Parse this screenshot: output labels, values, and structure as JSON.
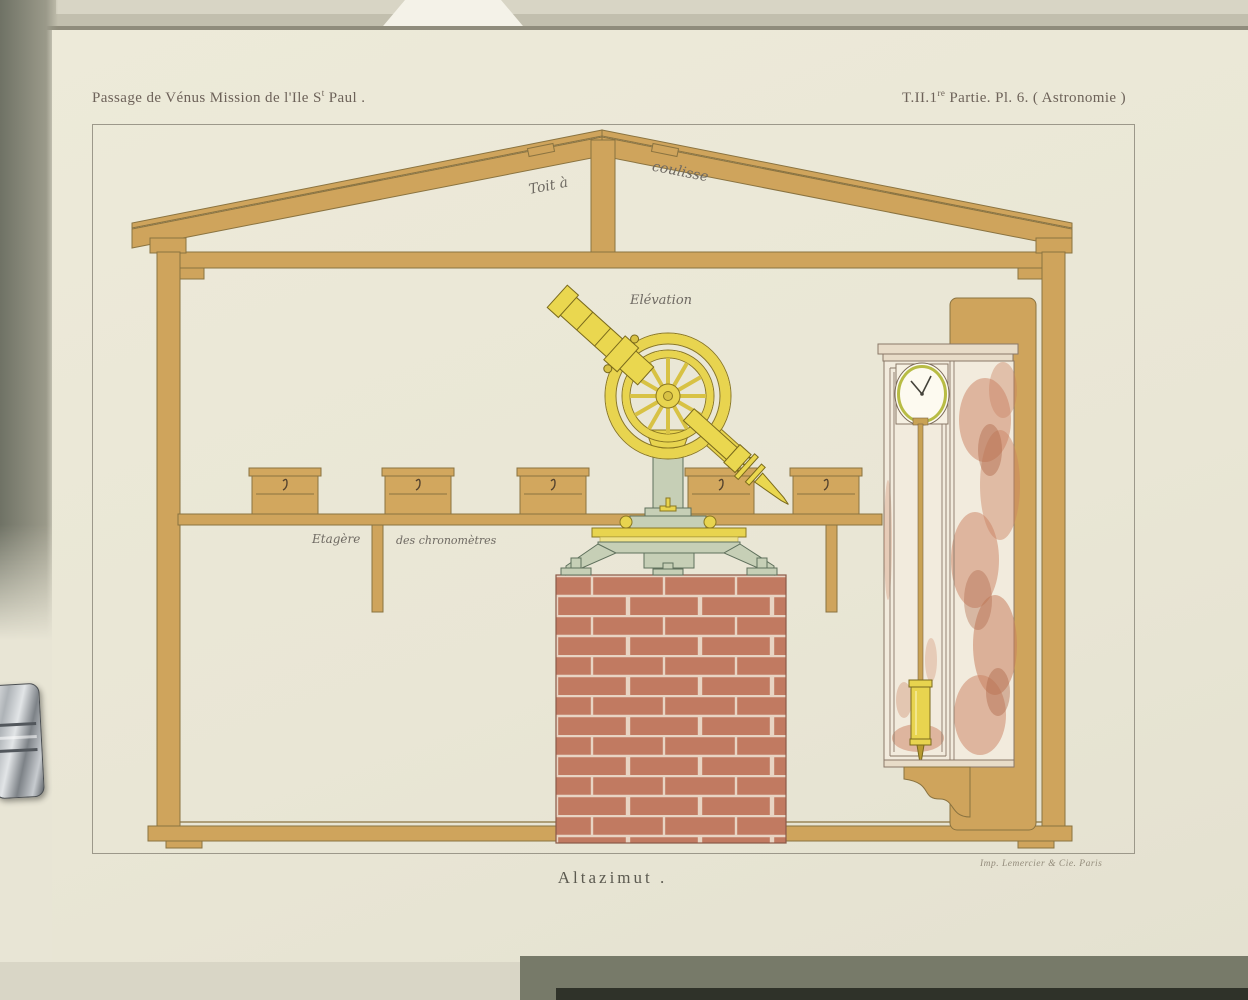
{
  "plate": {
    "header_left": {
      "text": "Passage de Vénus Mission de l'Ile S",
      "sup": "t",
      "suffix": " Paul ."
    },
    "header_right": {
      "text": "T.II.1",
      "sup": "re",
      "suffix": " Partie. Pl. 6. ( Astronomie )"
    },
    "labels": {
      "roof_left": "Toit à",
      "roof_right": "coulisse",
      "elevation": "Elévation",
      "shelf_left": "Etagère",
      "shelf_right": "des chronomètres"
    },
    "caption": "Altazimut .",
    "imprint": "Imp. Lemercier & Cie. Paris"
  },
  "colors": {
    "paper": "#ebe8d8",
    "wood": "#cfa45c",
    "brick": "#c17a61",
    "brick_mortar": "#e8d4c3",
    "brass": "#e8d44f",
    "stand_green": "#c6cfb6",
    "clock_mottle": "#c9805f"
  }
}
